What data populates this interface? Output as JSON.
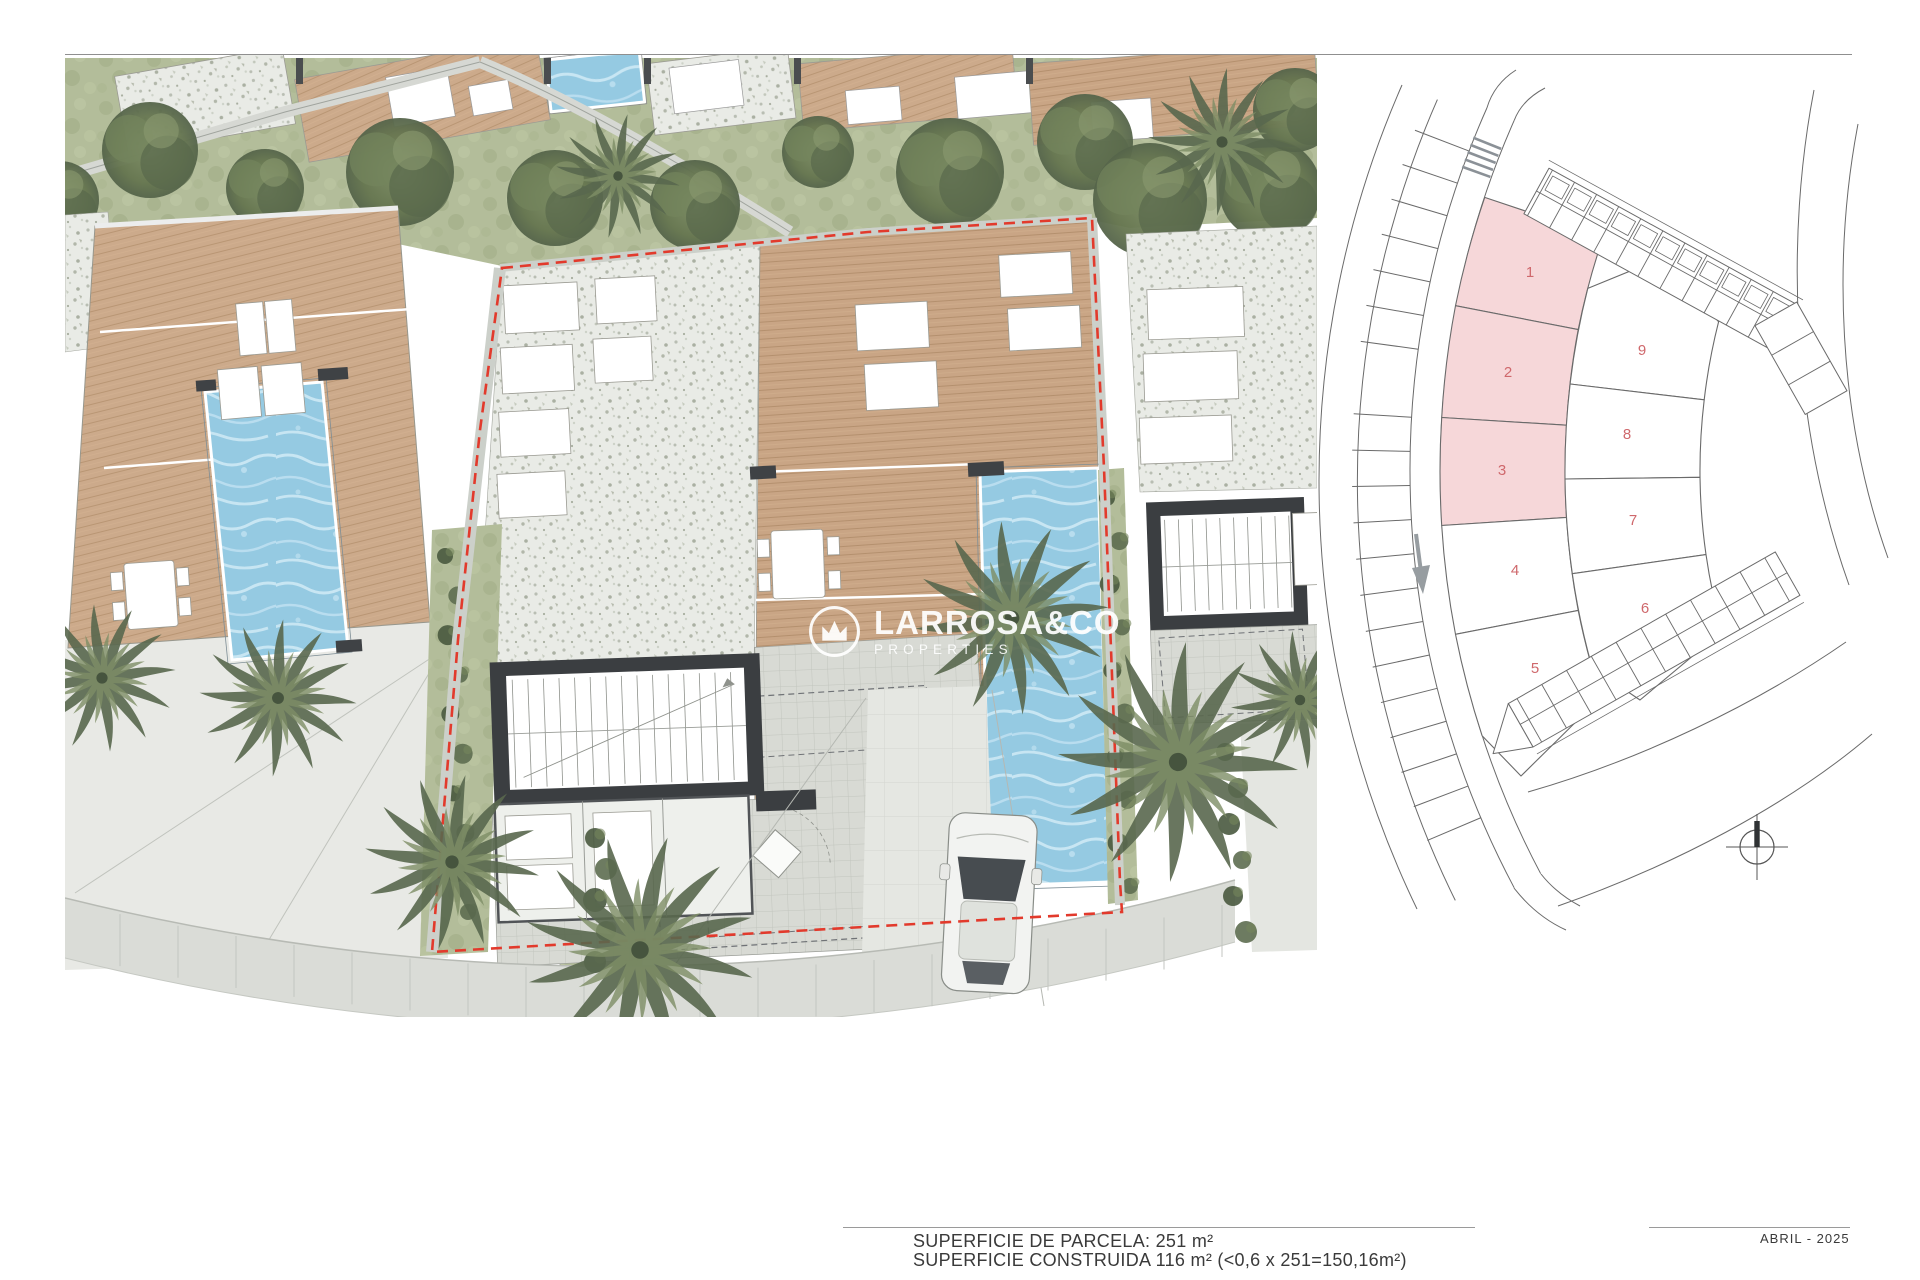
{
  "watermark": {
    "brand": "LARROSA&CO",
    "tagline": "PROPERTIES"
  },
  "annotations": {
    "parcel_area": "SUPERFICIE DE PARCELA: 251 m²",
    "built_area": "SUPERFICIE CONSTRUIDA 116 m² (<0,6 x 251=150,16m²)",
    "date": "ABRIL - 2025"
  },
  "key_plan": {
    "highlight_color": "#f6d7d9",
    "number_color": "#cf686c",
    "line_color": "#6a6a6a",
    "highlighted_plots": [
      "1",
      "2",
      "3"
    ],
    "plots": [
      {
        "label": "1",
        "highlighted": true
      },
      {
        "label": "2",
        "highlighted": true
      },
      {
        "label": "3",
        "highlighted": true
      },
      {
        "label": "4",
        "highlighted": false
      },
      {
        "label": "5",
        "highlighted": false
      },
      {
        "label": "6",
        "highlighted": false
      },
      {
        "label": "7",
        "highlighted": false
      },
      {
        "label": "8",
        "highlighted": false
      },
      {
        "label": "9",
        "highlighted": false
      }
    ]
  },
  "site_plan": {
    "boundary_color": "#e23a2c",
    "pool_color": "#95cae2",
    "deck_color": "#c9a585",
    "gravel_color": "#e9ebe6",
    "vegetation_color": "#62724f",
    "house_wall_color": "#3b3e41"
  }
}
